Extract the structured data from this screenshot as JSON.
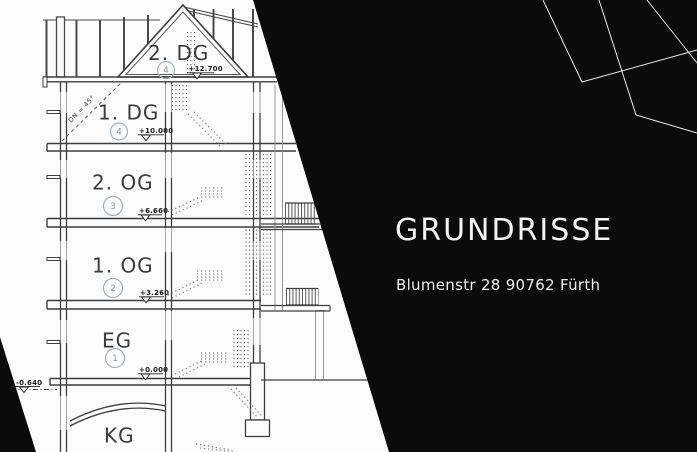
{
  "header": {
    "title": "GRUNDRISSE",
    "subtitle": "Blumenstr 28 90762 Fürth"
  },
  "drawing": {
    "floors": [
      {
        "label": "2. DG",
        "badge": "4",
        "level": "+12.700"
      },
      {
        "label": "1. DG",
        "badge": "4",
        "level": "+10.000"
      },
      {
        "label": "2. OG",
        "badge": "3",
        "level": "+6.660"
      },
      {
        "label": "1. OG",
        "badge": "2",
        "level": "+3.260"
      },
      {
        "label": "EG",
        "badge": "1",
        "level": "+0.000"
      },
      {
        "label": "KG",
        "badge": "",
        "level": ""
      }
    ],
    "ground_level": "-0.640",
    "roof_pitch_note": "DN = 45°"
  },
  "colors": {
    "overlay": "#0b0b0b",
    "line": "#3f3f3f",
    "deco_line": "#e8e8e8"
  }
}
